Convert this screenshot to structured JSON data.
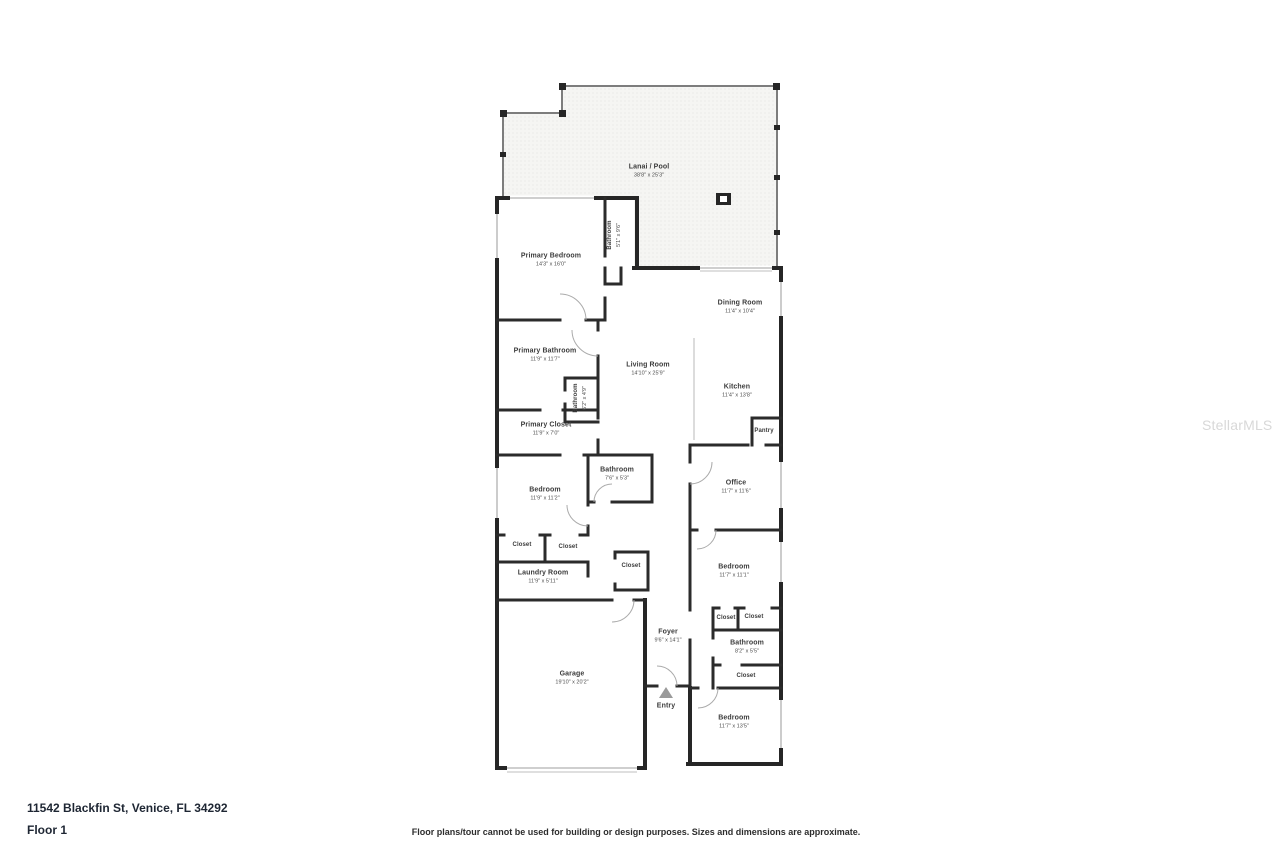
{
  "page": {
    "address": "11542 Blackfin St, Venice, FL 34292",
    "floor_label": "Floor 1",
    "disclaimer": "Floor plans/tour cannot be used for building or design purposes. Sizes and dimensions are approximate.",
    "watermark": "StellarMLS"
  },
  "colors": {
    "wall": "#262626",
    "window": "#bfbfbf",
    "lanai_fill": "#f5f5f3",
    "lanai_dot": "#dcdcdc",
    "label_text": "#3c3c3c",
    "watermark_text": "#d8d8d8"
  },
  "rooms": {
    "lanai": {
      "label": "Lanai / Pool",
      "dims": "38'8\" x 25'3\""
    },
    "primary_bedroom": {
      "label": "Primary Bedroom",
      "dims": "14'3\" x 16'0\""
    },
    "bathroom_lanai": {
      "label": "Bathroom",
      "dims": "5'1\" x 9'6\""
    },
    "dining_room": {
      "label": "Dining Room",
      "dims": "11'4\" x 10'4\""
    },
    "living_room": {
      "label": "Living Room",
      "dims": "14'10\" x 25'9\""
    },
    "kitchen": {
      "label": "Kitchen",
      "dims": "11'4\" x 13'8\""
    },
    "primary_bathroom": {
      "label": "Primary Bathroom",
      "dims": "11'9\" x 11'7\""
    },
    "bathroom_small": {
      "label": "Bathroom",
      "dims": "6'2\" x 4'9\""
    },
    "primary_closet": {
      "label": "Primary Closet",
      "dims": "11'9\" x 7'0\""
    },
    "pantry": {
      "label": "Pantry"
    },
    "bathroom_center": {
      "label": "Bathroom",
      "dims": "7'6\" x 5'3\""
    },
    "office": {
      "label": "Office",
      "dims": "11'7\" x 11'6\""
    },
    "bedroom_left": {
      "label": "Bedroom",
      "dims": "11'9\" x 11'2\""
    },
    "closet_left_1": {
      "label": "Closet"
    },
    "closet_left_2": {
      "label": "Closet"
    },
    "laundry": {
      "label": "Laundry Room",
      "dims": "11'9\" x 5'11\""
    },
    "closet_hall": {
      "label": "Closet"
    },
    "bedroom_right": {
      "label": "Bedroom",
      "dims": "11'7\" x 11'1\""
    },
    "closet_right_1": {
      "label": "Closet"
    },
    "closet_right_2": {
      "label": "Closet"
    },
    "bathroom_right": {
      "label": "Bathroom",
      "dims": "8'2\" x 5'5\""
    },
    "closet_right_3": {
      "label": "Closet"
    },
    "foyer": {
      "label": "Foyer",
      "dims": "9'6\" x 14'1\""
    },
    "entry": {
      "label": "Entry"
    },
    "garage": {
      "label": "Garage",
      "dims": "19'10\" x 20'2\""
    },
    "bedroom_bottom": {
      "label": "Bedroom",
      "dims": "11'7\" x 13'5\""
    }
  }
}
